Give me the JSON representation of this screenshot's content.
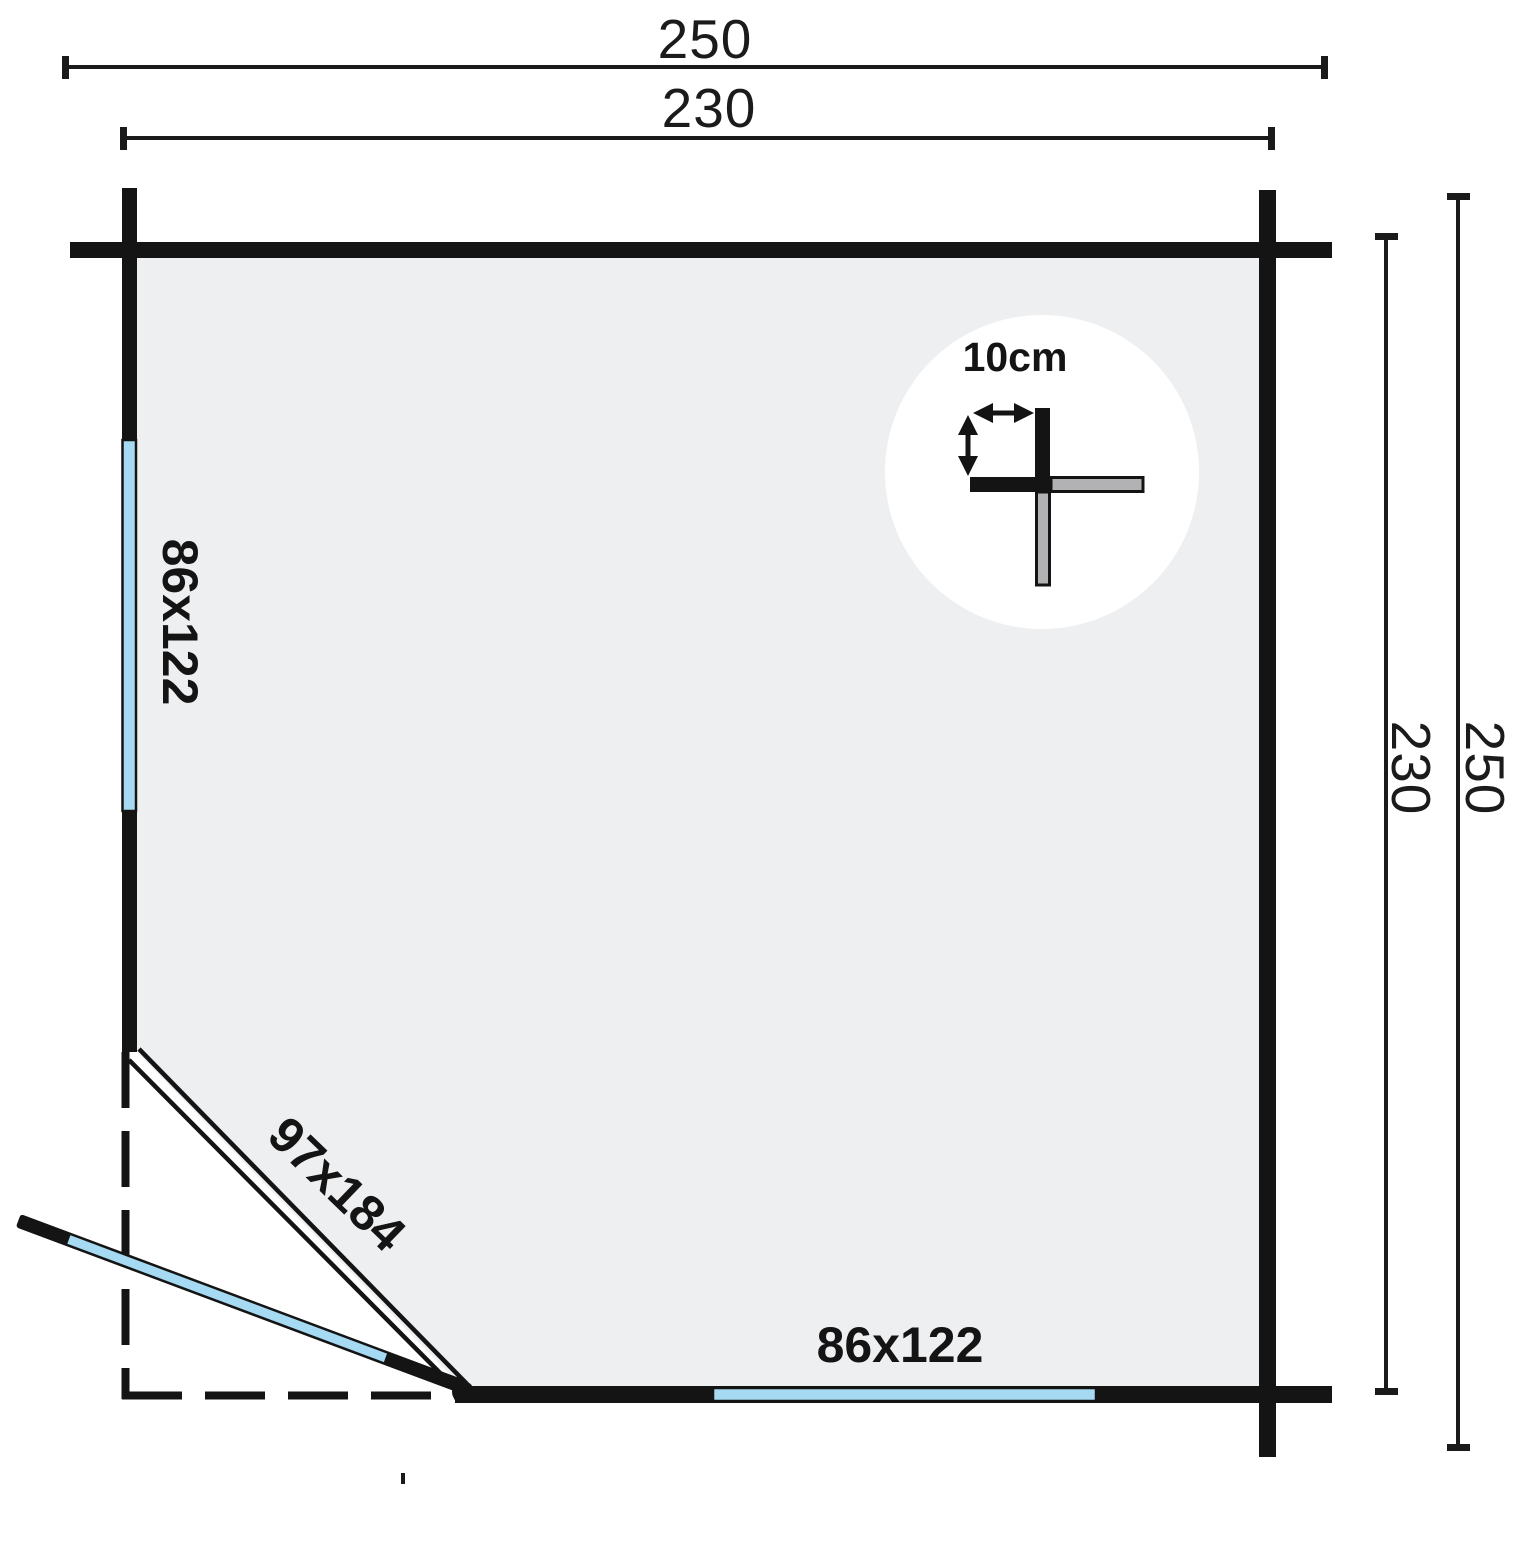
{
  "plan": {
    "title": "corner-cabin-floor-plan",
    "dimensions": {
      "top_outer": "250",
      "top_inner": "230",
      "right_inner": "230",
      "right_outer": "250"
    },
    "windows": {
      "left_label": "86x122",
      "bottom_label": "86x122"
    },
    "door": {
      "label": "97x184"
    },
    "detail": {
      "wall_thickness_label": "10cm"
    },
    "colors": {
      "wall": "#141414",
      "interior": "#eeeff1",
      "glazing": "#a6d9f2",
      "log_grey": "#b2b2b4",
      "background": "#ffffff"
    }
  }
}
